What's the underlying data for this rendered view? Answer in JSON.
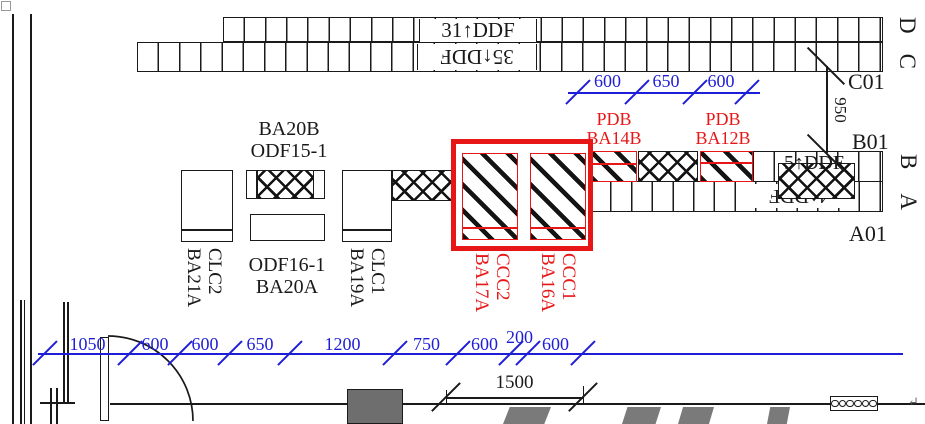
{
  "drawing": {
    "texts": {
      "ddf_row_d": "31↑DDF",
      "ddf_row_c": "35↑DDF",
      "ddf_row_b": "5↑DDF",
      "ddf_row_a": "4↑DDF",
      "grid_d": "D",
      "grid_c": "C",
      "grid_b": "B",
      "grid_a": "A",
      "c01": "C01",
      "b01": "B01",
      "a01": "A01",
      "ba20b": "BA20B",
      "odf15": "ODF15-1",
      "odf16": "ODF16-1",
      "ba20a": "BA20A",
      "clc2": "CLC2",
      "ba21a": "BA21A",
      "clc1": "CLC1",
      "ba19a": "BA19A",
      "pdb1_line1": "PDB",
      "pdb1_line2": "BA14B",
      "pdb2_line1": "PDB",
      "pdb2_line2": "BA12B",
      "ccc2": "CCC2",
      "ba17a": "BA17A",
      "ccc1": "CCC1",
      "ba16a": "BA16A",
      "return_mark": "↵"
    },
    "colors": {
      "dimension_blue": "#1e1ed8",
      "highlight_red": "#e81717",
      "line_black": "#1a1a1a"
    },
    "rack_rows": [
      {
        "id": "row-d",
        "x": 223,
        "y": 17,
        "w": 660,
        "h": 25,
        "cells": 31
      },
      {
        "id": "row-c",
        "x": 137,
        "y": 42,
        "w": 746,
        "h": 30,
        "cells": 35
      },
      {
        "id": "row-b",
        "x": 753,
        "y": 151,
        "w": 130,
        "h": 31,
        "cells": 6
      },
      {
        "id": "row-a",
        "x": 590,
        "y": 181,
        "w": 293,
        "h": 31,
        "cells": 14
      }
    ],
    "dimensions": [
      {
        "id": "top-spacing",
        "orient": "h",
        "color": "#1e1ed8",
        "y": 92,
        "x1": 568,
        "x2": 760,
        "ticks": [
          578,
          637,
          695,
          747
        ],
        "tick_len": 34,
        "tick_angle": 45,
        "label_dy": -21,
        "font": 18,
        "segments": [
          {
            "v": "600"
          },
          {
            "v": "650"
          },
          {
            "v": "600"
          }
        ]
      },
      {
        "id": "bottom-run",
        "orient": "h",
        "color": "#1e1ed8",
        "y": 353,
        "x1": 38,
        "x2": 903,
        "ticks": [
          45,
          130,
          180,
          230,
          290,
          395,
          458,
          511,
          528,
          583
        ],
        "tick_len": 34,
        "tick_angle": 45,
        "label_dy": -19,
        "font": 18,
        "segments": [
          {
            "v": "1050"
          },
          {
            "v": "600"
          },
          {
            "v": "600"
          },
          {
            "v": "650"
          },
          {
            "v": "1200"
          },
          {
            "v": "750"
          },
          {
            "v": "600"
          },
          {
            "v": "200",
            "dy": -26
          },
          {
            "v": "600"
          }
        ]
      },
      {
        "id": "gap-950",
        "orient": "v",
        "color": "#1a1a1a",
        "x": 826,
        "y1": 66,
        "y2": 153,
        "ticks": [
          66,
          153
        ],
        "tick_len": 52,
        "tick_angle": -45,
        "font": 17,
        "label": "950"
      },
      {
        "id": "door-1500",
        "orient": "h",
        "color": "#1a1a1a",
        "y": 397,
        "x1": 446,
        "x2": 583,
        "ticks": [
          446,
          583
        ],
        "tick_len": 40,
        "tick_angle": 45,
        "label_dy": -25,
        "font": 19,
        "segments": [
          {
            "v": "1500"
          }
        ]
      }
    ]
  }
}
